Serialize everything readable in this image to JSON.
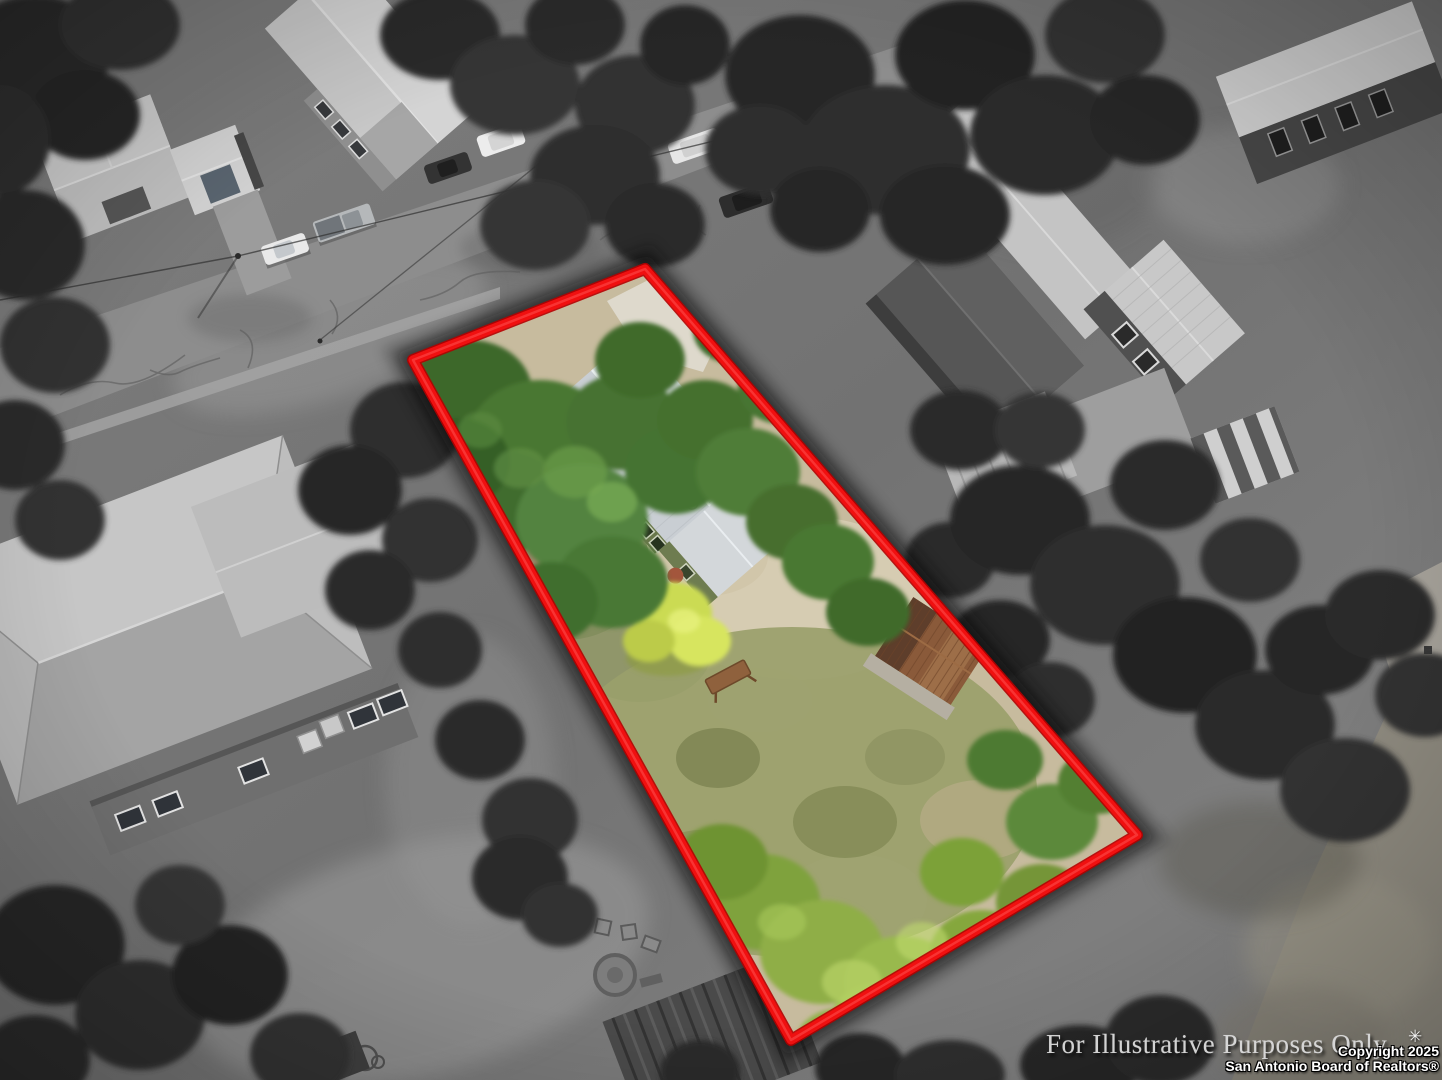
{
  "overlay": {
    "watermark": "For Illustrative Purposes Only",
    "sparkle_icon": "✳",
    "copyright_line1": "Copyright 2025",
    "copyright_line2": "San Antonio Board of Realtors®"
  },
  "boundary": {
    "color": "#f01010",
    "points": "645,269 1137,835 791,1040 413,360"
  },
  "palette": {
    "street": "#8d8d8d",
    "lot_dirt": "#c7bb9e",
    "lot_grass": "#9aa06b",
    "canopy_green": "#497733",
    "bush_yellow": "#cbdb52",
    "house_roof": "#c9ced3",
    "house_wall": "#69774b",
    "shed_rust": "#8a5a3a",
    "driveway": "#ded9cc"
  }
}
